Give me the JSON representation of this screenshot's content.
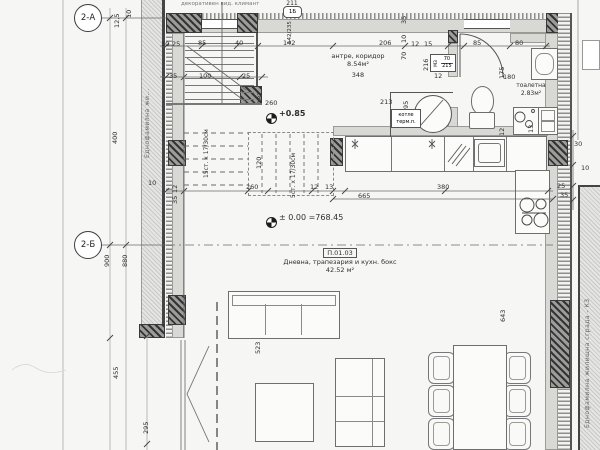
{
  "axes": {
    "a_label": "2-А",
    "b_label": "2-Б"
  },
  "site": {
    "left_building": "Еднофамилна жи...",
    "right_building": "Еднофамилна жилищна сграда - К3",
    "top_note": "декоративен вид. климант"
  },
  "levels": {
    "upper": "+0.85",
    "ground": "± 0.00 =768.45"
  },
  "rooms": {
    "hall": {
      "name": "антре, коридор",
      "area": "8.54м²",
      "number": "348"
    },
    "wc": {
      "name": "тоалетна",
      "area": "2.83м²"
    },
    "living": {
      "code": "П.01.03",
      "name": "Дневна, трапезария и кухн. бокс",
      "area": "42.52 м²"
    },
    "boiler": {
      "line1": "котле",
      "line2": "терм.п."
    }
  },
  "stairs": {
    "flight_main": "15ст. x 17/30см",
    "flight_upper": "5ст. x 17/30см"
  },
  "tags": {
    "window_top": {
      "head": "211",
      "mark": "1Б",
      "size": "142/235"
    },
    "door_wc": {
      "mark": "МЗ",
      "w": "70",
      "h": "215"
    }
  },
  "dims": [
    {
      "t": "85",
      "x": 198,
      "y": 40
    },
    {
      "t": "40",
      "x": 235,
      "y": 40
    },
    {
      "t": "142",
      "x": 283,
      "y": 40
    },
    {
      "t": "206",
      "x": 379,
      "y": 40
    },
    {
      "t": "12",
      "x": 411,
      "y": 41
    },
    {
      "t": "15",
      "x": 424,
      "y": 41
    },
    {
      "t": "85",
      "x": 473,
      "y": 40
    },
    {
      "t": "80",
      "x": 515,
      "y": 40
    },
    {
      "t": "10",
      "x": 161,
      "y": 41
    },
    {
      "t": "25",
      "x": 172,
      "y": 41
    },
    {
      "t": "35",
      "x": 169,
      "y": 73
    },
    {
      "t": "100",
      "x": 199,
      "y": 73
    },
    {
      "t": "25",
      "x": 242,
      "y": 73
    },
    {
      "t": "35",
      "x": 401,
      "y": 24,
      "r": 1
    },
    {
      "t": "10",
      "x": 401,
      "y": 43,
      "r": 1
    },
    {
      "t": "70",
      "x": 401,
      "y": 60,
      "r": 1
    },
    {
      "t": "187",
      "x": 257,
      "y": 104,
      "r": 1
    },
    {
      "t": "260",
      "x": 265,
      "y": 100
    },
    {
      "t": "213",
      "x": 380,
      "y": 99
    },
    {
      "t": "95",
      "x": 403,
      "y": 109,
      "r": 1
    },
    {
      "t": "216",
      "x": 423,
      "y": 71,
      "r": 1
    },
    {
      "t": "12",
      "x": 434,
      "y": 73
    },
    {
      "t": "175",
      "x": 499,
      "y": 79,
      "r": 1
    },
    {
      "t": "180",
      "x": 503,
      "y": 74
    },
    {
      "t": "120",
      "x": 256,
      "y": 169,
      "r": 1
    },
    {
      "t": "260",
      "x": 246,
      "y": 184
    },
    {
      "t": "12",
      "x": 310,
      "y": 184
    },
    {
      "t": "13",
      "x": 325,
      "y": 184
    },
    {
      "t": "380",
      "x": 437,
      "y": 184
    },
    {
      "t": "665",
      "x": 358,
      "y": 193
    },
    {
      "t": "13",
      "x": 528,
      "y": 133,
      "r": 1
    },
    {
      "t": "12",
      "x": 499,
      "y": 136,
      "r": 1
    },
    {
      "t": "30",
      "x": 574,
      "y": 141
    },
    {
      "t": "10",
      "x": 581,
      "y": 165
    },
    {
      "t": "25",
      "x": 557,
      "y": 183
    },
    {
      "t": "35",
      "x": 560,
      "y": 192
    },
    {
      "t": "400",
      "x": 112,
      "y": 144,
      "r": 1
    },
    {
      "t": "900",
      "x": 104,
      "y": 267,
      "r": 1
    },
    {
      "t": "880",
      "x": 122,
      "y": 267,
      "r": 1
    },
    {
      "t": "455",
      "x": 113,
      "y": 379,
      "r": 1
    },
    {
      "t": "295",
      "x": 143,
      "y": 434,
      "r": 1
    },
    {
      "t": "12,5",
      "x": 114,
      "y": 28,
      "r": 1
    },
    {
      "t": "10",
      "x": 126,
      "y": 18,
      "r": 1
    },
    {
      "t": "10",
      "x": 148,
      "y": 180
    },
    {
      "t": "12",
      "x": 172,
      "y": 193,
      "r": 1
    },
    {
      "t": "35",
      "x": 172,
      "y": 204,
      "r": 1
    },
    {
      "t": "523",
      "x": 255,
      "y": 354,
      "r": 1
    },
    {
      "t": "643",
      "x": 500,
      "y": 322,
      "r": 1
    }
  ]
}
